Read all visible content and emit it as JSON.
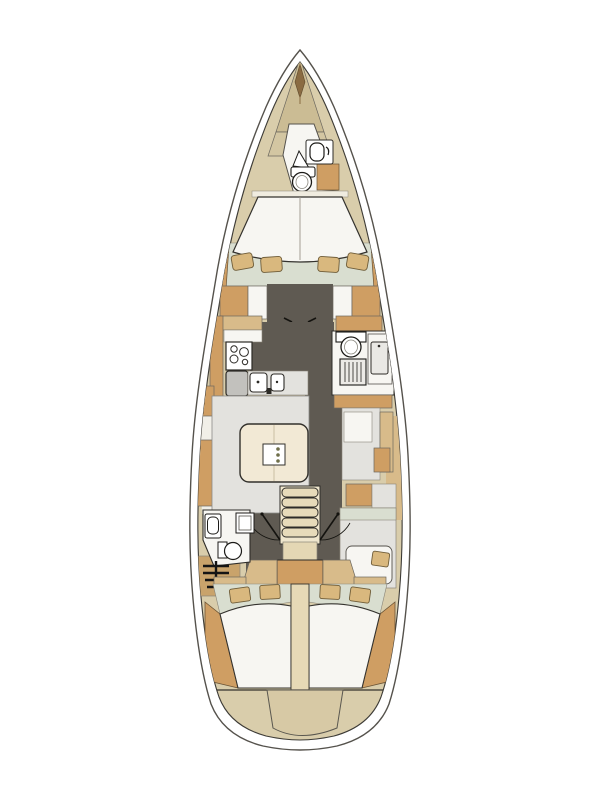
{
  "diagram": {
    "kind": "sailboat-interior-floorplan",
    "orientation": "bow-up",
    "background": "#ffffff"
  },
  "palette": {
    "outline": "#2e2c28",
    "hull_line": "#55524c",
    "interior": "#d9cdab",
    "bow_dark": "#cbbc94",
    "bow_light": "#d3c6a2",
    "wood": "#cf9e63",
    "wood_light": "#d8bb8a",
    "floor": "#5f5a52",
    "furniture": "#e3e2de",
    "furniture_dark": "#c2c1bd",
    "white": "#f7f6f2",
    "green": "#d9ded0",
    "table": "#f2e9d5",
    "pillow": "#d9b87e",
    "step": "#e7dbba",
    "bulkhead": "#e6d9b6",
    "transom_locker": "#d7c9a5",
    "anchor": "#8a6b42",
    "table_dots": "#6f6f4a"
  },
  "regions": {
    "bow_locker": "anchor-locker",
    "forward_head": "forward-head-wc",
    "forward_cabin": "forward-owner-cabin",
    "galley": "galley-port",
    "starboard_head": "starboard-head-shower",
    "salon": "salon-settee-table",
    "nav_area": "starboard-seat-desk",
    "companionway": "companionway-stairs",
    "port_head": "port-aft-head",
    "aft_cabin_port": "aft-cabin-port",
    "aft_cabin_starboard": "aft-cabin-starboard",
    "transom": "transom-locker"
  }
}
